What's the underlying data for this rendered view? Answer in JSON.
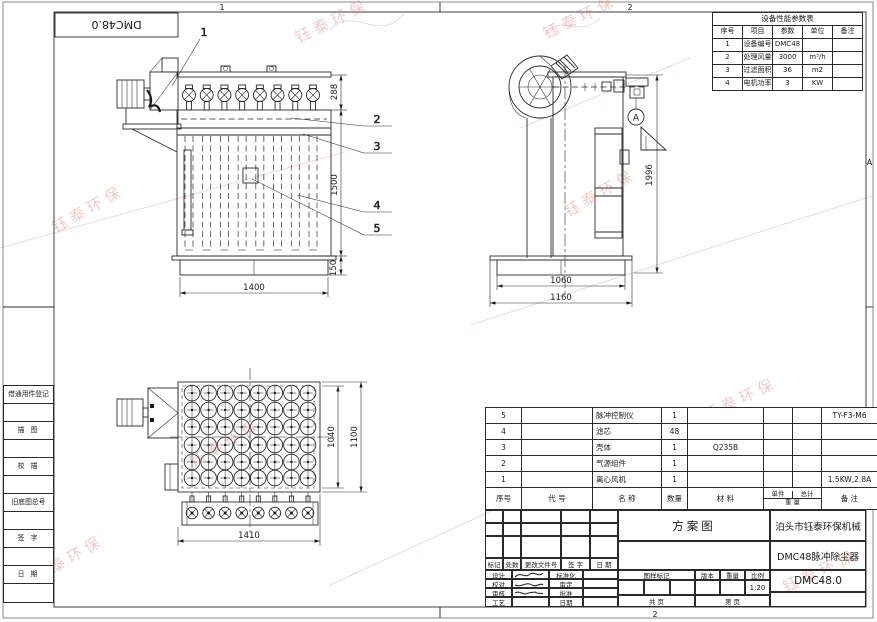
{
  "sheet": {
    "corner_label": "DMC48.0",
    "zones": {
      "top_left": "1",
      "top_right": "2",
      "bottom": "2",
      "right_top": "A",
      "right_bottom": "B"
    }
  },
  "watermark": {
    "text": "钰泰环保",
    "color": "#d97f7f"
  },
  "margin_column": {
    "items": [
      "借通用件登记",
      "描 图",
      "校 描",
      "旧底图总号",
      "签 字",
      "日 期"
    ]
  },
  "params_table": {
    "title": "设备性能参数表",
    "headers": [
      "序号",
      "项目",
      "参数",
      "单位",
      "备注"
    ],
    "rows": [
      [
        "1",
        "设备编号",
        "DMC48",
        "",
        ""
      ],
      [
        "2",
        "处理风量",
        "3000",
        "m³/h",
        ""
      ],
      [
        "3",
        "过滤面积",
        "36",
        "m2",
        ""
      ],
      [
        "4",
        "电机功率",
        "3",
        "KW",
        ""
      ]
    ]
  },
  "views": {
    "front": {
      "dims": {
        "top_height": "288",
        "body_height": "1500",
        "base_height": "150",
        "width": "1400"
      },
      "callouts": [
        "1",
        "2",
        "3",
        "4",
        "5"
      ]
    },
    "side": {
      "dims": {
        "height": "1996",
        "base_inner": "1060",
        "base_outer": "1160"
      },
      "balloon": "A"
    },
    "top": {
      "dims": {
        "inner_depth": "1040",
        "outer_depth": "1100",
        "width": "1410"
      }
    }
  },
  "bom": {
    "headers": {
      "seq": "序号",
      "code": "代  号",
      "name": "名  称",
      "qty": "数量",
      "material": "材  料",
      "unit_weight": "单件",
      "total_weight": "总计",
      "weight": "重 量",
      "remark": "备  注"
    },
    "rows": [
      {
        "seq": "5",
        "code": "",
        "name": "脉冲控制仪",
        "qty": "1",
        "material": "",
        "uw": "",
        "tw": "",
        "remark": "TY-F3-M6"
      },
      {
        "seq": "4",
        "code": "",
        "name": "滤芯",
        "qty": "48",
        "material": "",
        "uw": "",
        "tw": "",
        "remark": ""
      },
      {
        "seq": "3",
        "code": "",
        "name": "壳体",
        "qty": "1",
        "material": "Q235B",
        "uw": "",
        "tw": "",
        "remark": ""
      },
      {
        "seq": "2",
        "code": "",
        "name": "气源组件",
        "qty": "1",
        "material": "",
        "uw": "",
        "tw": "",
        "remark": ""
      },
      {
        "seq": "1",
        "code": "",
        "name": "离心风机",
        "qty": "1",
        "material": "",
        "uw": "",
        "tw": "",
        "remark": "1.5KW,2.8A"
      }
    ]
  },
  "title_block": {
    "revision_headers": [
      "标记",
      "处数",
      "更改文件号",
      "签 字",
      "日 期"
    ],
    "sign_rows": [
      {
        "left": "设计",
        "right": "标准化"
      },
      {
        "left": "校对",
        "right": "审定"
      },
      {
        "left": "审核",
        "right": "批准"
      },
      {
        "left": "工艺",
        "right": "日期"
      }
    ],
    "drawing_type": "方案图",
    "company": "泊头市钰泰环保机械",
    "product": "DMC48脉冲除尘器",
    "drawing_no": "DMC48.0",
    "stamp_headers": [
      "图样标记",
      "版本",
      "重量",
      "比例"
    ],
    "scale": "1:20",
    "pages": {
      "total": "共  页",
      "page": "第  页"
    }
  }
}
